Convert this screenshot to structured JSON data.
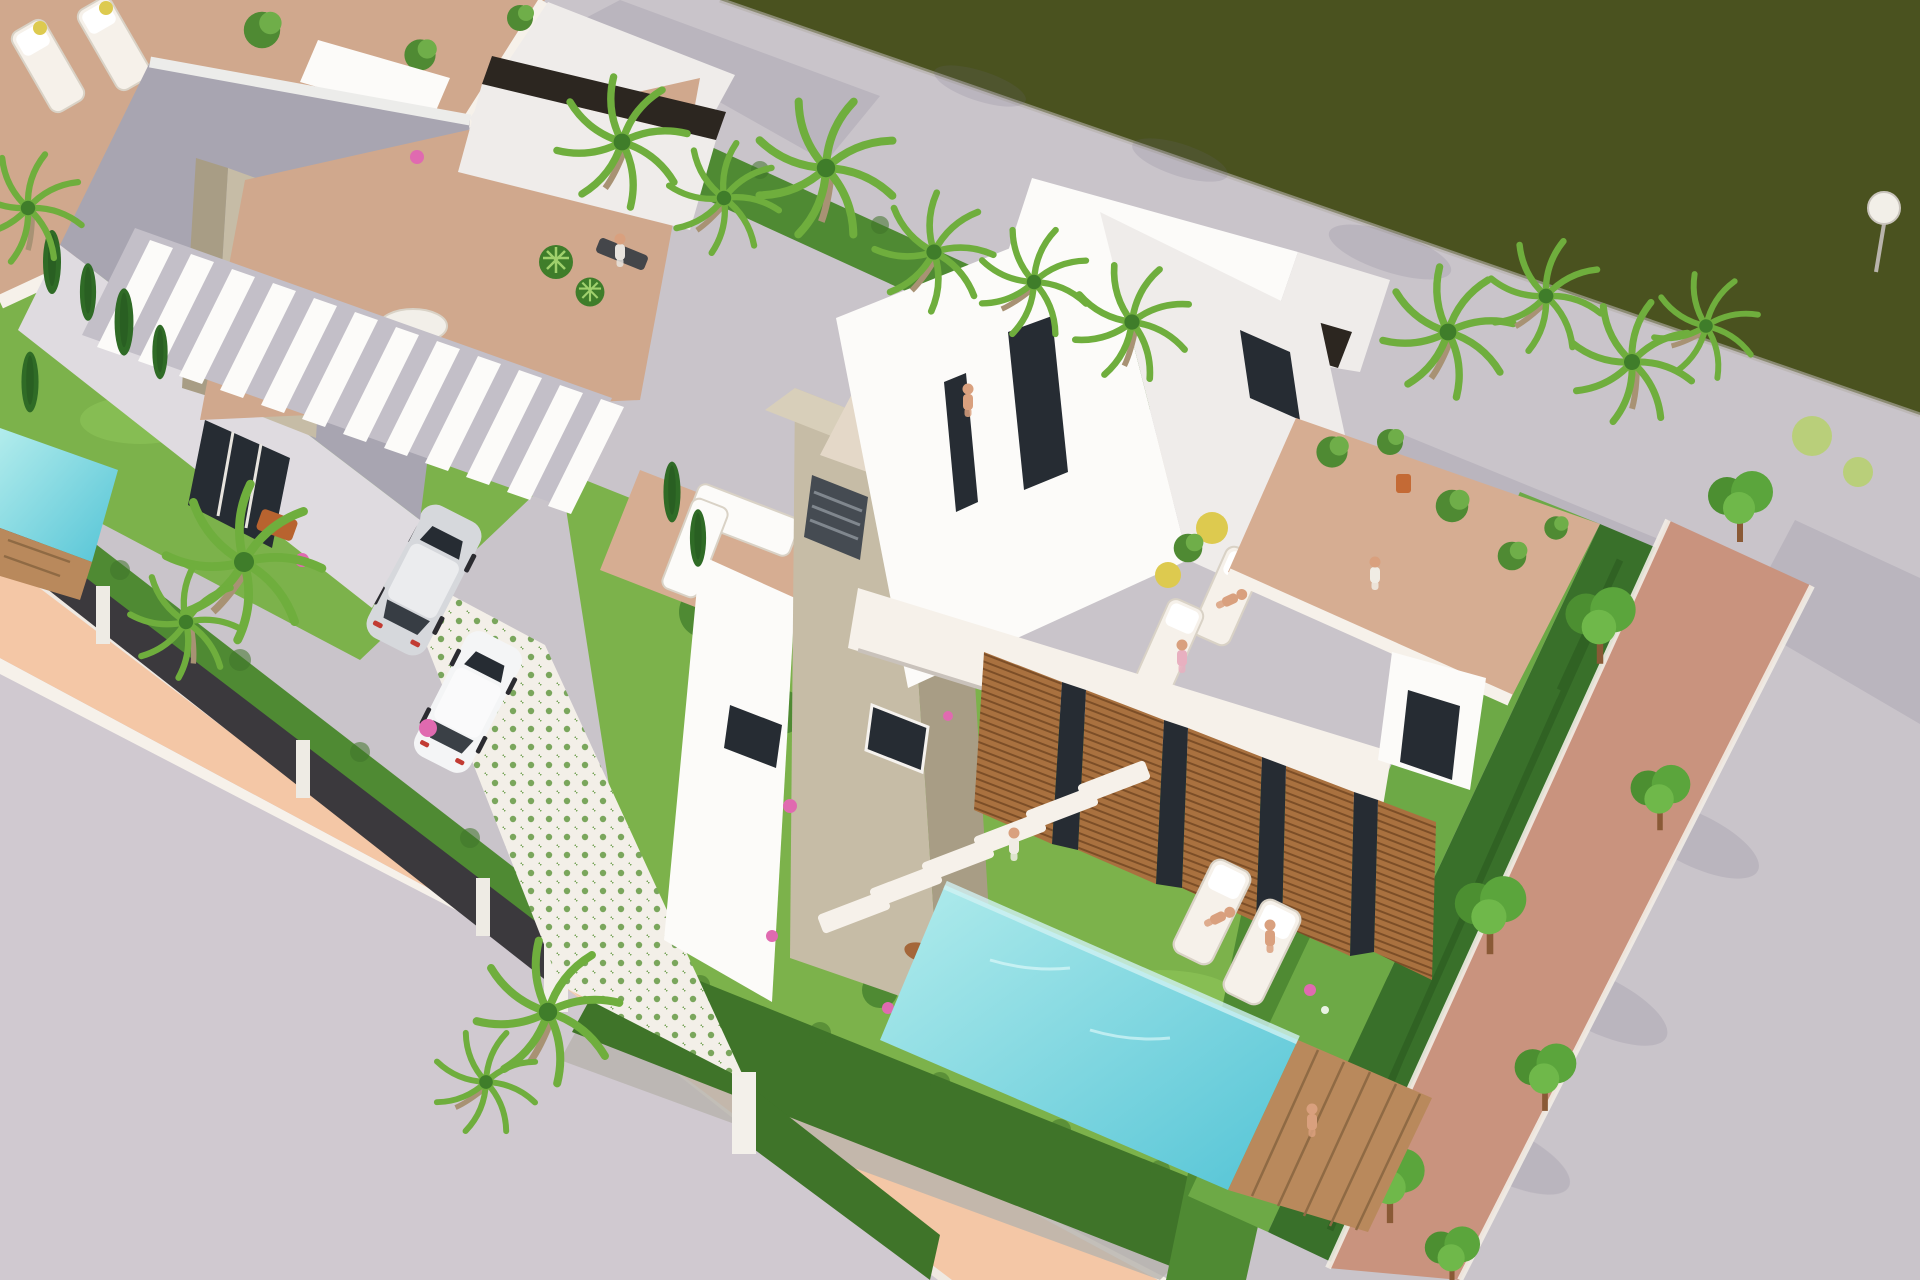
{
  "meta": {
    "content_type": "3d-architectural-render",
    "description": "Aerial isometric 3D rendering of a row of modern white villas with rooftop terraces, private pools, gardens, palm trees, parked cars and a tree-lined grey street beside a dark green water channel",
    "no_visible_text": true
  },
  "palette": {
    "water": "#4a521f",
    "roadUpper": "#c9c4ca",
    "roadLower": "#d0c9d0",
    "curbWhite": "#f6f1ea",
    "lowWallWhite": "#efe9e2",
    "sidewalkSalmon": "#f4c7a6",
    "treeStripGround": "#c9937e",
    "wallWhite": "#fcfbf9",
    "wallLight": "#efecea",
    "wallShaded": "#a8a5b1",
    "wallSoft": "#dfdbe0",
    "parapetDark": "#2c2620",
    "stone": "#c6bca6",
    "stoneShade": "#a89d85",
    "wood": "#a9713f",
    "woodDark": "#7c4e27",
    "glass": "#262c33",
    "terrace": "#d0a88d",
    "terraceWarm": "#d6ad92",
    "grass": "#7cb24b",
    "grassLight": "#95cc5e",
    "hedge": "#4f8a33",
    "hedgeDark": "#3f7429",
    "hedgeDeep": "#39702a",
    "flowerHedge": "#6da946",
    "ivy": "#4e8134",
    "cypress": "#2f6b26",
    "palmFrond": "#6fae3d",
    "palmCore": "#3f7d2a",
    "treeGreen": "#5ba53c",
    "poolLight": "#b2ecec",
    "poolDeep": "#54c4d6",
    "deckWood": "#b9895c",
    "fence": "#3b393d",
    "tileBase": "#f3efe8",
    "tileGreen": "#7aa65c",
    "carSilver": "#d6d8dc",
    "carWhite": "#f4f5f6",
    "skin": "#d9a07e",
    "dogBrown": "#a4673a",
    "accentYellow": "#ddca4f",
    "flowerPink": "#e06ab0",
    "potOrange": "#c46a35",
    "shadow": "#6d6680"
  },
  "scene": {
    "setting": {
      "water_channel": "dark olive-green water channel along the top right",
      "streets": [
        "grey asphalt street running along the water",
        "grey pavement filling the lower left corner",
        "salmon coloured walkway with white kerbs between pavement and villas",
        "brick coloured planting strip with a row of round clipped trees beside the right street"
      ]
    },
    "villas": [
      {
        "id": "left-villa",
        "features": [
          "rooftop terrace with white sun loungers and plant pots",
          "wooden dining table",
          "travertine chimney with vent and slot window",
          "large shaded side wall",
          "floor-to-ceiling glazing",
          "garden with cypresses and palm trees",
          "small turquoise plunge pool with wooden deck"
        ]
      },
      {
        "id": "middle-villa",
        "features": [
          "white slatted pergola roof",
          "roof terrace with round table, big-leaf plants and white lounge sofa",
          "tall travertine chimney tower with vent grille and slot window",
          "person relaxing on a bench",
          "green patterned tile driveway with two parked cars"
        ]
      },
      {
        "id": "right-villa",
        "features": [
          "two storey white volume with dark parapet caps on stair towers",
          "roof lounge with dark rattan sofas, coffee table and yellow flowers",
          "sun deck with loungers, sunbathers and yellow parasol balls",
          "terracotta terrace with potted plants and an orange pot",
          "wooden louvre shutter panels on the garden facade",
          "lawn with stepping stones, pink flowers and a dog",
          "long turquoise pool with wooden deck",
          "two sun loungers on the lawn"
        ]
      }
    ],
    "vehicles": [
      {
        "id": "silver-minivan"
      },
      {
        "id": "white-hatchback"
      }
    ],
    "people": [
      {
        "activity": "sitting on roof bench"
      },
      {
        "activity": "lounging on dark rattan roof sofa"
      },
      {
        "activity": "sunbathing on roof lounger"
      },
      {
        "activity": "sitting on roof lounger"
      },
      {
        "activity": "walking on terracotta terrace"
      },
      {
        "activity": "walking on garden stepping stones"
      },
      {
        "activity": "sunbathing on lawn lounger"
      },
      {
        "activity": "sitting on lawn lounger"
      },
      {
        "activity": "sitting on pool deck with feet in the water"
      }
    ],
    "animals": [
      {
        "id": "dog",
        "location": "garden lawn"
      }
    ],
    "vegetation": {
      "palm_trees": 15,
      "cypress_trees": 7,
      "street_trees": 7,
      "hedges": "clipped hedges along fences, driveway and pool",
      "flowers": [
        "pink bougainvillea",
        "white flower hedge"
      ]
    },
    "street_furniture": [
      "dark metal boundary fence with white posts",
      "white gate pillars",
      "spherical street lamp"
    ]
  }
}
